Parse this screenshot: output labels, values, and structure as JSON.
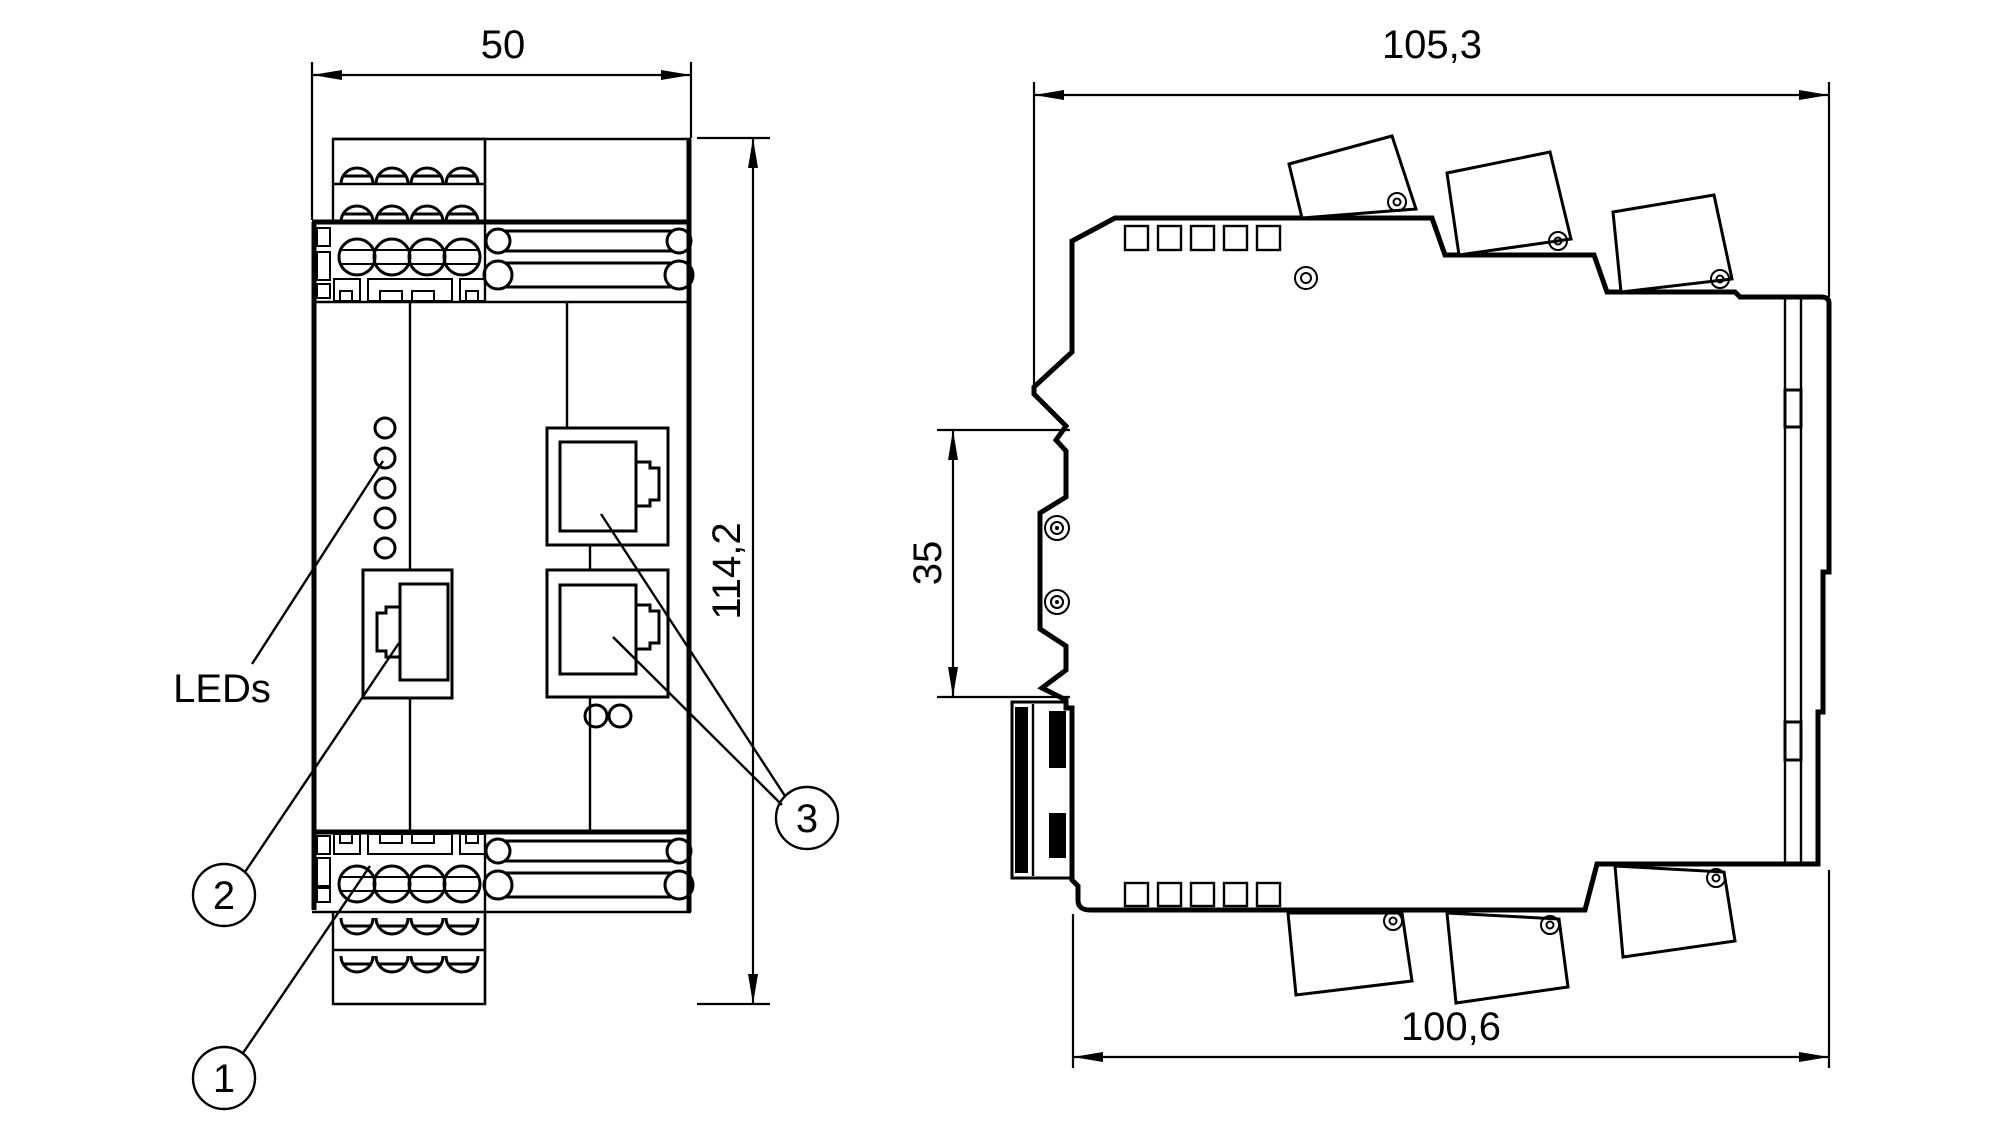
{
  "front_view": {
    "width": "50",
    "height": "114,2",
    "leds_label": "LEDs",
    "callouts": {
      "c1": "1",
      "c2": "2",
      "c3": "3"
    }
  },
  "side_view": {
    "overall_depth": "105,3",
    "din_rail_height": "35",
    "housing_depth": "100,6"
  },
  "colors": {
    "line": "#000000",
    "background": "#ffffff"
  }
}
